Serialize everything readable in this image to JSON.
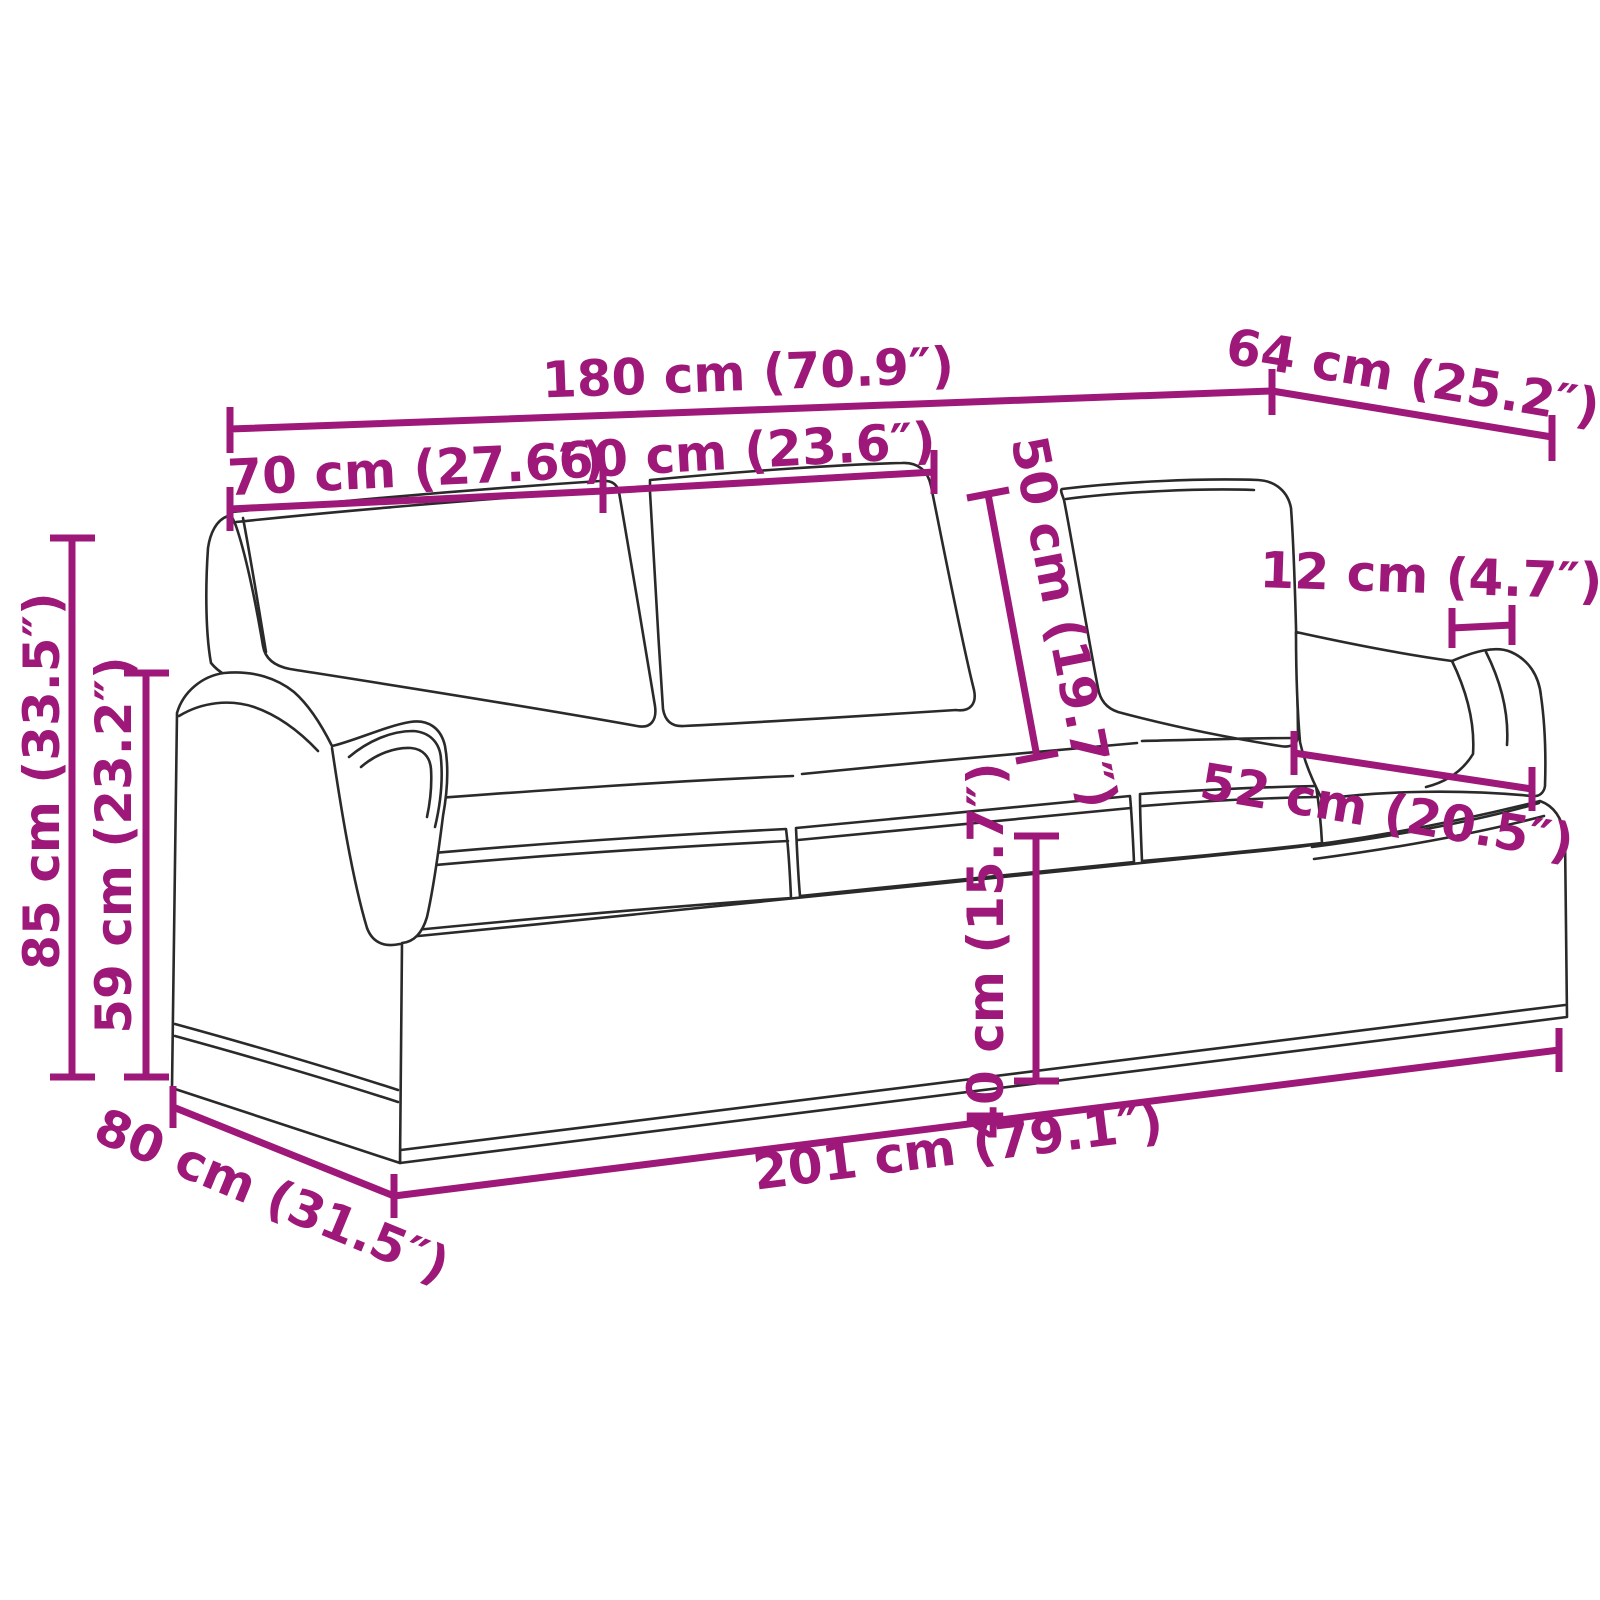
{
  "diagram": {
    "type": "furniture-dimension-diagram",
    "subject": "three-seat sofa line drawing with measurements",
    "colors": {
      "background": "#ffffff",
      "dimension_accent": "#9D1878",
      "artwork_line": "#2a2a2a"
    }
  },
  "dimensions": [
    {
      "id": "overall-width-180",
      "label": "180 cm (70.9″)"
    },
    {
      "id": "back-depth-64",
      "label": "64 cm (25.2″)"
    },
    {
      "id": "arm-section-width-70",
      "label": "70 cm (27.6″)"
    },
    {
      "id": "cushion-width-60",
      "label": "60 cm (23.6″)"
    },
    {
      "id": "back-cushion-height-50",
      "label": "50 cm (19.7″)"
    },
    {
      "id": "armrest-top-width-12",
      "label": "12 cm (4.7″)"
    },
    {
      "id": "seat-depth-52",
      "label": "52 cm (20.5″)"
    },
    {
      "id": "total-height-85",
      "label": "85 cm (33.5″)"
    },
    {
      "id": "arm-height-59",
      "label": "59 cm (23.2″)"
    },
    {
      "id": "seat-height-40",
      "label": "40 cm (15.7″)"
    },
    {
      "id": "base-width-201",
      "label": "201 cm (79.1″)"
    },
    {
      "id": "base-depth-80",
      "label": "80 cm (31.5″)"
    }
  ]
}
